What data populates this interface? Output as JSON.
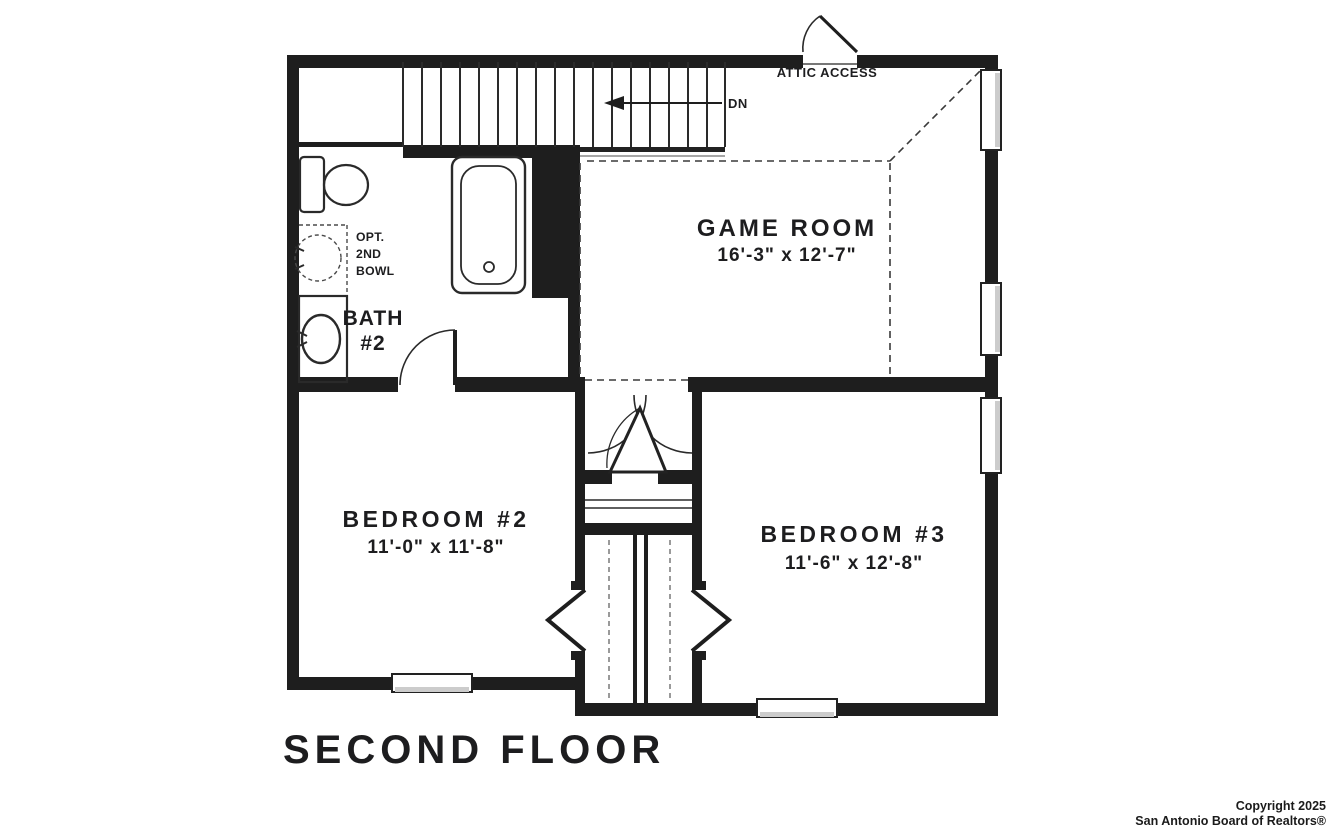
{
  "page": {
    "background": "#ffffff",
    "ink": "#1e1e1e"
  },
  "title": {
    "text": "SECOND FLOOR"
  },
  "plan": {
    "annotations": {
      "attic_access": "ATTIC ACCESS",
      "down_label": "DN",
      "opt_bowl_line1": "OPT.",
      "opt_bowl_line2": "2ND",
      "opt_bowl_line3": "BOWL"
    },
    "rooms": {
      "game_room": {
        "name": "GAME ROOM",
        "dims": "16'-3\" x 12'-7\""
      },
      "bedroom_2": {
        "name": "BEDROOM #2",
        "dims": "11'-0\" x 11'-8\""
      },
      "bedroom_3": {
        "name": "BEDROOM #3",
        "dims": "11'-6\" x 12'-8\""
      },
      "bath_2": {
        "name_line1": "BATH",
        "name_line2": "#2"
      }
    }
  },
  "footer": {
    "copyright_line1": "Copyright 2025",
    "copyright_line2": "San Antonio Board of Realtors®"
  }
}
